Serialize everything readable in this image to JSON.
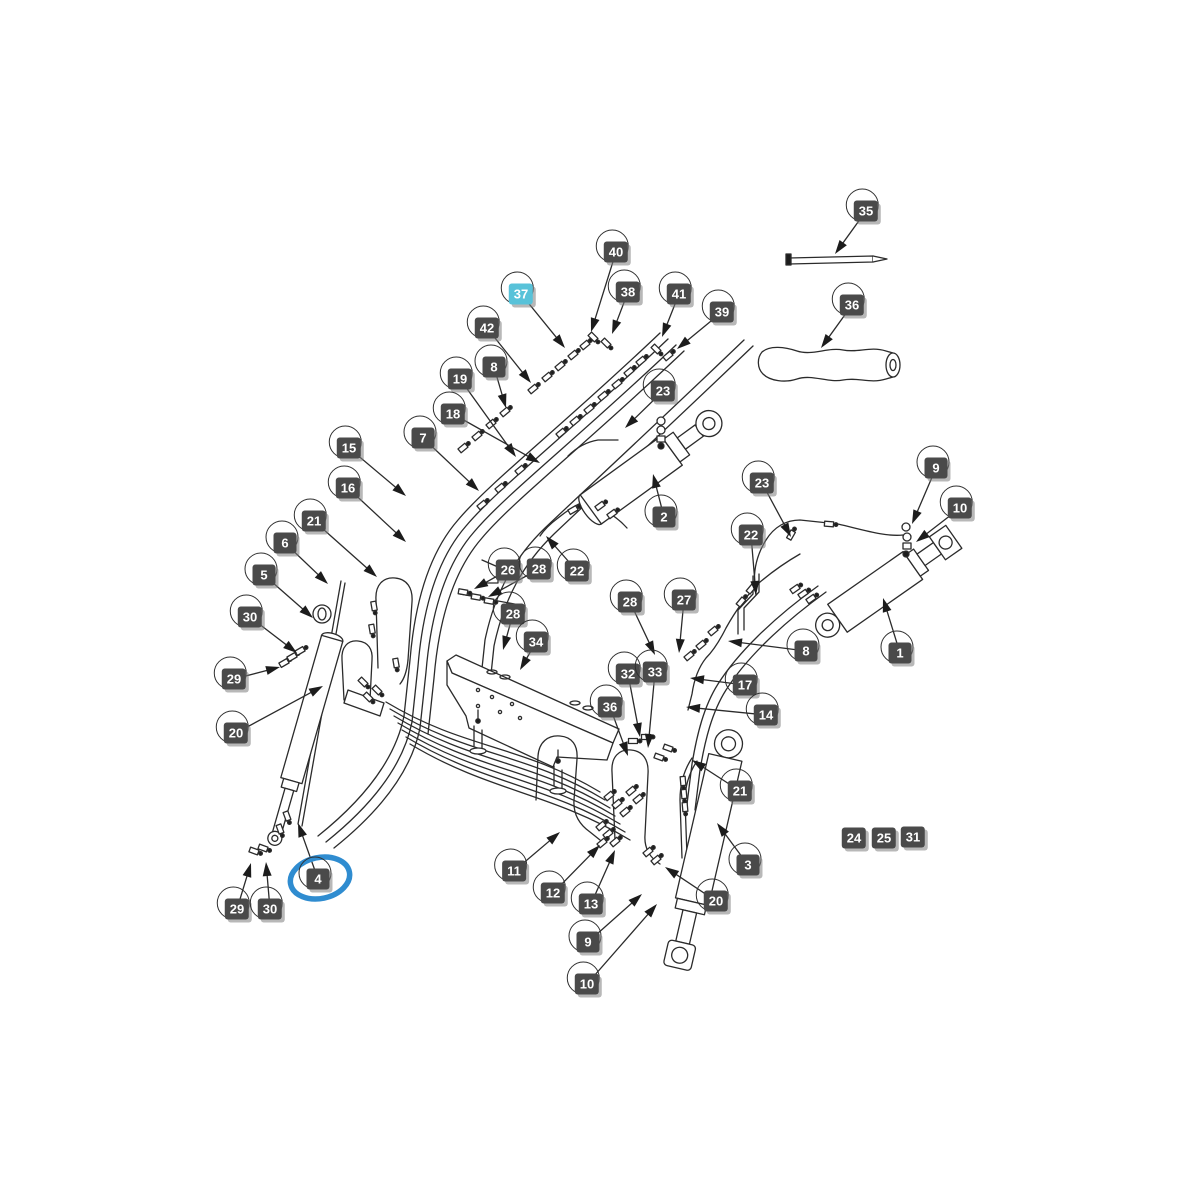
{
  "page": {
    "background_color": "#ffffff",
    "kind": "exploded-parts-diagram"
  },
  "diagram": {
    "line_color": "#2b2b2b",
    "badge_color": "#4a4a4a",
    "badge_text_color": "#ffffff",
    "highlight_badge_color": "#58c2d9",
    "selection_ring_color": "#2f8cd0",
    "highlighted_part": "37",
    "selected_part": "4",
    "labels": [
      {
        "n": "35",
        "x": 866,
        "y": 211,
        "tip": [
          835,
          254
        ]
      },
      {
        "n": "36",
        "x": 852,
        "y": 305,
        "tip": [
          821,
          348
        ]
      },
      {
        "n": "40",
        "x": 616,
        "y": 252,
        "tip": [
          591,
          332
        ]
      },
      {
        "n": "37",
        "x": 521,
        "y": 294,
        "tip": [
          565,
          348
        ],
        "highlight": true
      },
      {
        "n": "38",
        "x": 628,
        "y": 292,
        "tip": [
          612,
          334
        ]
      },
      {
        "n": "41",
        "x": 679,
        "y": 294,
        "tip": [
          662,
          337
        ]
      },
      {
        "n": "39",
        "x": 722,
        "y": 312,
        "tip": [
          677,
          349
        ]
      },
      {
        "n": "42",
        "x": 487,
        "y": 328,
        "tip": [
          531,
          383
        ]
      },
      {
        "n": "8",
        "x": 494,
        "y": 367,
        "tip": [
          506,
          408
        ]
      },
      {
        "n": "19",
        "x": 460,
        "y": 379,
        "tip": [
          516,
          457
        ]
      },
      {
        "n": "18",
        "x": 453,
        "y": 414,
        "tip": [
          540,
          463
        ]
      },
      {
        "n": "7",
        "x": 423,
        "y": 438,
        "tip": [
          479,
          491
        ]
      },
      {
        "n": "23",
        "x": 663,
        "y": 391,
        "tip": [
          625,
          428
        ]
      },
      {
        "n": "15",
        "x": 349,
        "y": 448,
        "tip": [
          406,
          496
        ]
      },
      {
        "n": "16",
        "x": 348,
        "y": 488,
        "tip": [
          406,
          542
        ]
      },
      {
        "n": "21",
        "x": 314,
        "y": 521,
        "tip": [
          377,
          577
        ]
      },
      {
        "n": "6",
        "x": 285,
        "y": 543,
        "tip": [
          328,
          584
        ]
      },
      {
        "n": "5",
        "x": 264,
        "y": 575,
        "tip": [
          313,
          618
        ]
      },
      {
        "n": "30",
        "x": 250,
        "y": 617,
        "tip": [
          297,
          653
        ]
      },
      {
        "n": "29",
        "x": 234,
        "y": 679,
        "tip": [
          280,
          667
        ]
      },
      {
        "n": "20",
        "x": 236,
        "y": 733,
        "tip": [
          323,
          686
        ]
      },
      {
        "n": "26",
        "x": 508,
        "y": 570,
        "tip": [
          474,
          589
        ]
      },
      {
        "n": "28",
        "x": 539,
        "y": 569,
        "tip": [
          488,
          597
        ]
      },
      {
        "n": "22",
        "x": 577,
        "y": 571,
        "tip": [
          546,
          536
        ]
      },
      {
        "n": "2",
        "x": 664,
        "y": 517,
        "tip": [
          653,
          474
        ]
      },
      {
        "n": "23",
        "x": 762,
        "y": 483,
        "tip": [
          791,
          537
        ]
      },
      {
        "n": "22",
        "x": 751,
        "y": 535,
        "tip": [
          756,
          595
        ]
      },
      {
        "n": "9",
        "x": 936,
        "y": 468,
        "tip": [
          912,
          524
        ]
      },
      {
        "n": "10",
        "x": 960,
        "y": 508,
        "tip": [
          916,
          542
        ]
      },
      {
        "n": "28",
        "x": 630,
        "y": 602,
        "tip": [
          655,
          655
        ]
      },
      {
        "n": "27",
        "x": 684,
        "y": 600,
        "tip": [
          679,
          653
        ]
      },
      {
        "n": "8",
        "x": 806,
        "y": 651,
        "tip": [
          728,
          641
        ]
      },
      {
        "n": "1",
        "x": 900,
        "y": 653,
        "tip": [
          883,
          598
        ]
      },
      {
        "n": "28",
        "x": 513,
        "y": 614,
        "tip": [
          503,
          650
        ]
      },
      {
        "n": "34",
        "x": 536,
        "y": 642,
        "tip": [
          520,
          670
        ]
      },
      {
        "n": "32",
        "x": 628,
        "y": 674,
        "tip": [
          640,
          737
        ]
      },
      {
        "n": "33",
        "x": 655,
        "y": 672,
        "tip": [
          648,
          748
        ]
      },
      {
        "n": "36",
        "x": 610,
        "y": 707,
        "tip": [
          628,
          756
        ]
      },
      {
        "n": "17",
        "x": 745,
        "y": 685,
        "tip": [
          690,
          678
        ]
      },
      {
        "n": "14",
        "x": 766,
        "y": 715,
        "tip": [
          686,
          707
        ]
      },
      {
        "n": "21",
        "x": 740,
        "y": 791,
        "tip": [
          692,
          760
        ]
      },
      {
        "n": "24",
        "x": 854,
        "y": 838,
        "plain": true
      },
      {
        "n": "25",
        "x": 884,
        "y": 838,
        "plain": true
      },
      {
        "n": "31",
        "x": 913,
        "y": 837,
        "plain": true
      },
      {
        "n": "11",
        "x": 514,
        "y": 871,
        "tip": [
          560,
          832
        ]
      },
      {
        "n": "12",
        "x": 553,
        "y": 893,
        "tip": [
          600,
          845
        ]
      },
      {
        "n": "13",
        "x": 591,
        "y": 904,
        "tip": [
          615,
          850
        ]
      },
      {
        "n": "9",
        "x": 588,
        "y": 942,
        "tip": [
          642,
          894
        ]
      },
      {
        "n": "10",
        "x": 587,
        "y": 984,
        "tip": [
          657,
          904
        ]
      },
      {
        "n": "20",
        "x": 716,
        "y": 901,
        "tip": [
          665,
          867
        ]
      },
      {
        "n": "3",
        "x": 748,
        "y": 865,
        "tip": [
          717,
          823
        ]
      },
      {
        "n": "4",
        "x": 318,
        "y": 879,
        "tip": [
          298,
          823
        ],
        "circled": true
      },
      {
        "n": "29",
        "x": 237,
        "y": 909,
        "tip": [
          251,
          863
        ]
      },
      {
        "n": "30",
        "x": 270,
        "y": 909,
        "tip": [
          266,
          862
        ]
      }
    ]
  }
}
